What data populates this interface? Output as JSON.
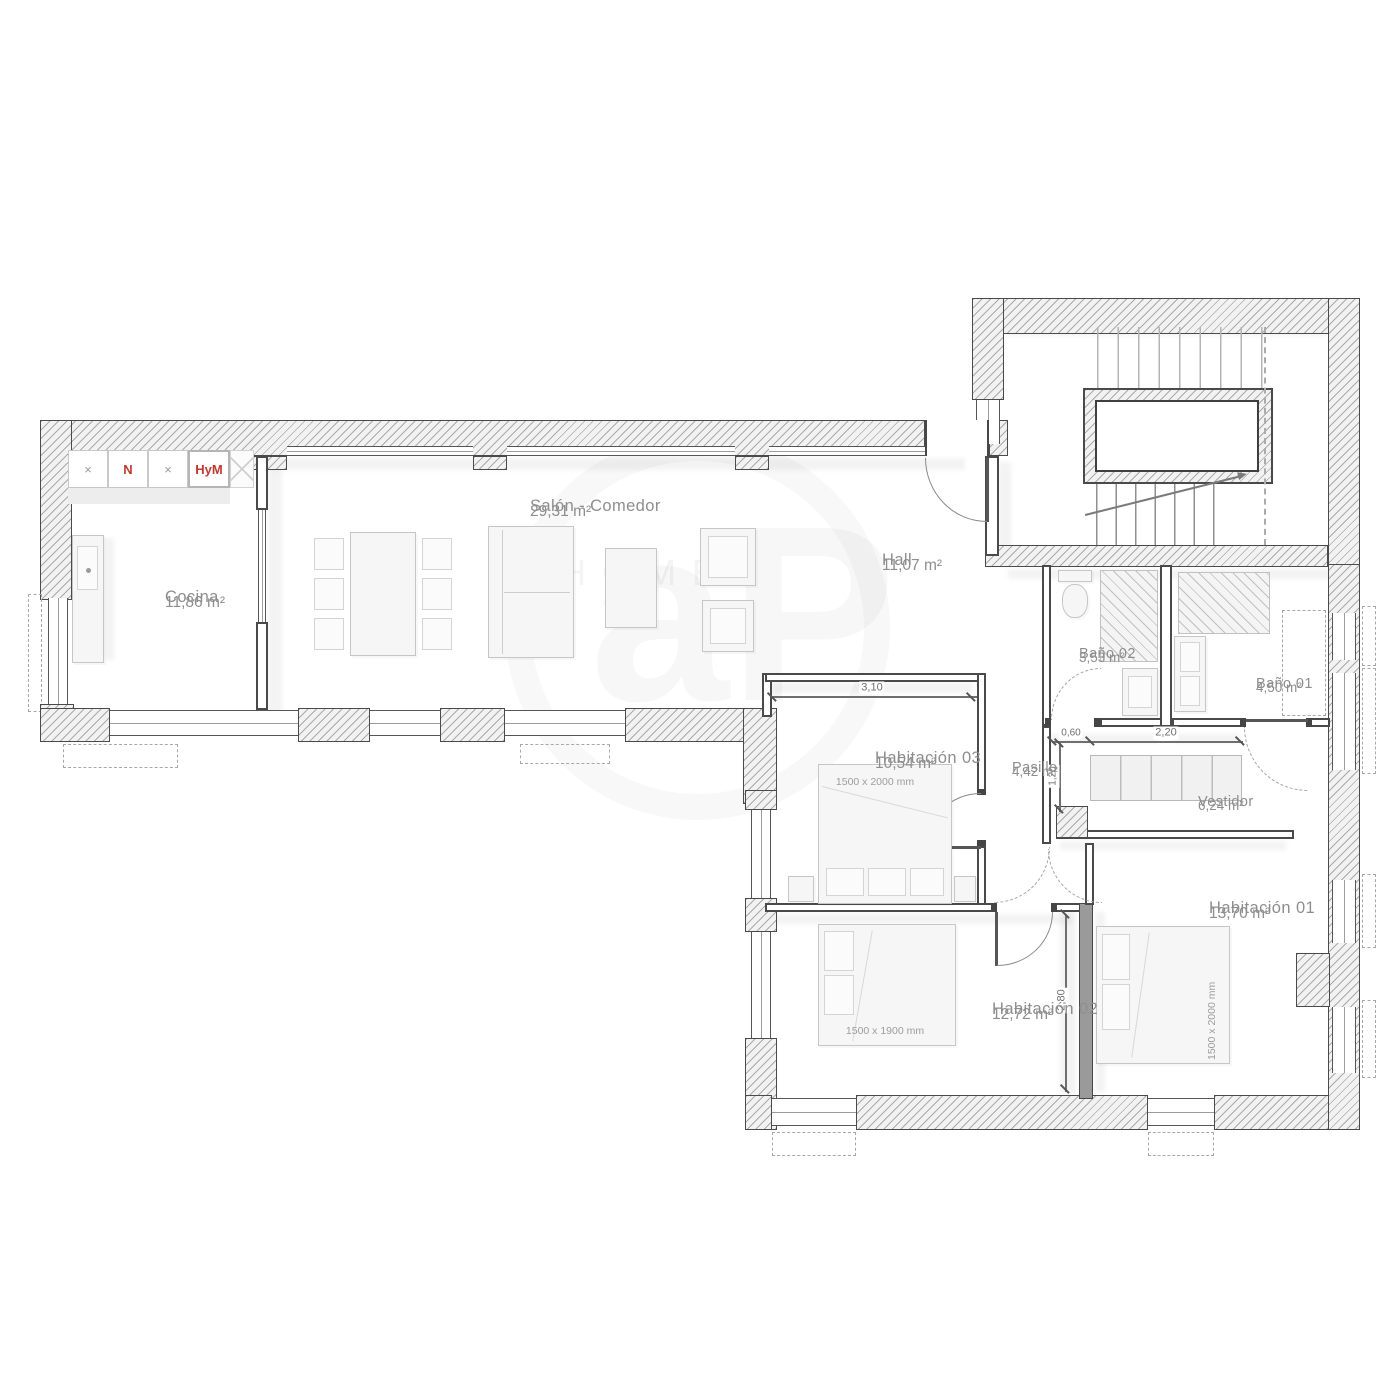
{
  "rooms": {
    "cocina": {
      "name": "Cocina",
      "area": "11,86 m²"
    },
    "salon": {
      "name": "Salón - Comedor",
      "area": "29,31 m²"
    },
    "hall": {
      "name": "Hall",
      "area": "11,07 m²"
    },
    "bano02": {
      "name": "Baño 02",
      "area": "3,53 m²"
    },
    "bano01": {
      "name": "Baño 01",
      "area": "4,50 m²"
    },
    "pasillo": {
      "name": "Pasillo",
      "area": "4,42 m²"
    },
    "vestidor": {
      "name": "Vestidor",
      "area": "6,24 m²"
    },
    "hab03": {
      "name": "Habitación 03",
      "area": "10,54 m²",
      "bed_size": "1500 x 2000 mm"
    },
    "hab02": {
      "name": "Habitación 02",
      "area": "12,72 m²",
      "bed_size": "1500 x 1900 mm"
    },
    "hab01": {
      "name": "Habitación 01",
      "area": "13,70 m²",
      "bed_size": "1500 x 2000 mm"
    }
  },
  "kitchen": {
    "cells": [
      "×",
      "N",
      "×",
      "HyM"
    ]
  },
  "dimensions": {
    "hab03_width": "3,10",
    "pasillo_width": "0,60",
    "vestidor_width": "2,20",
    "pasillo_height": "1,20",
    "hab02_height": "2,80"
  },
  "watermark": {
    "text": "HOMES",
    "monogram": "aP"
  },
  "colors": {
    "accent_red": "#c4382f",
    "wall": "#4a4a4a",
    "label_gray": "#8e8e8e"
  }
}
